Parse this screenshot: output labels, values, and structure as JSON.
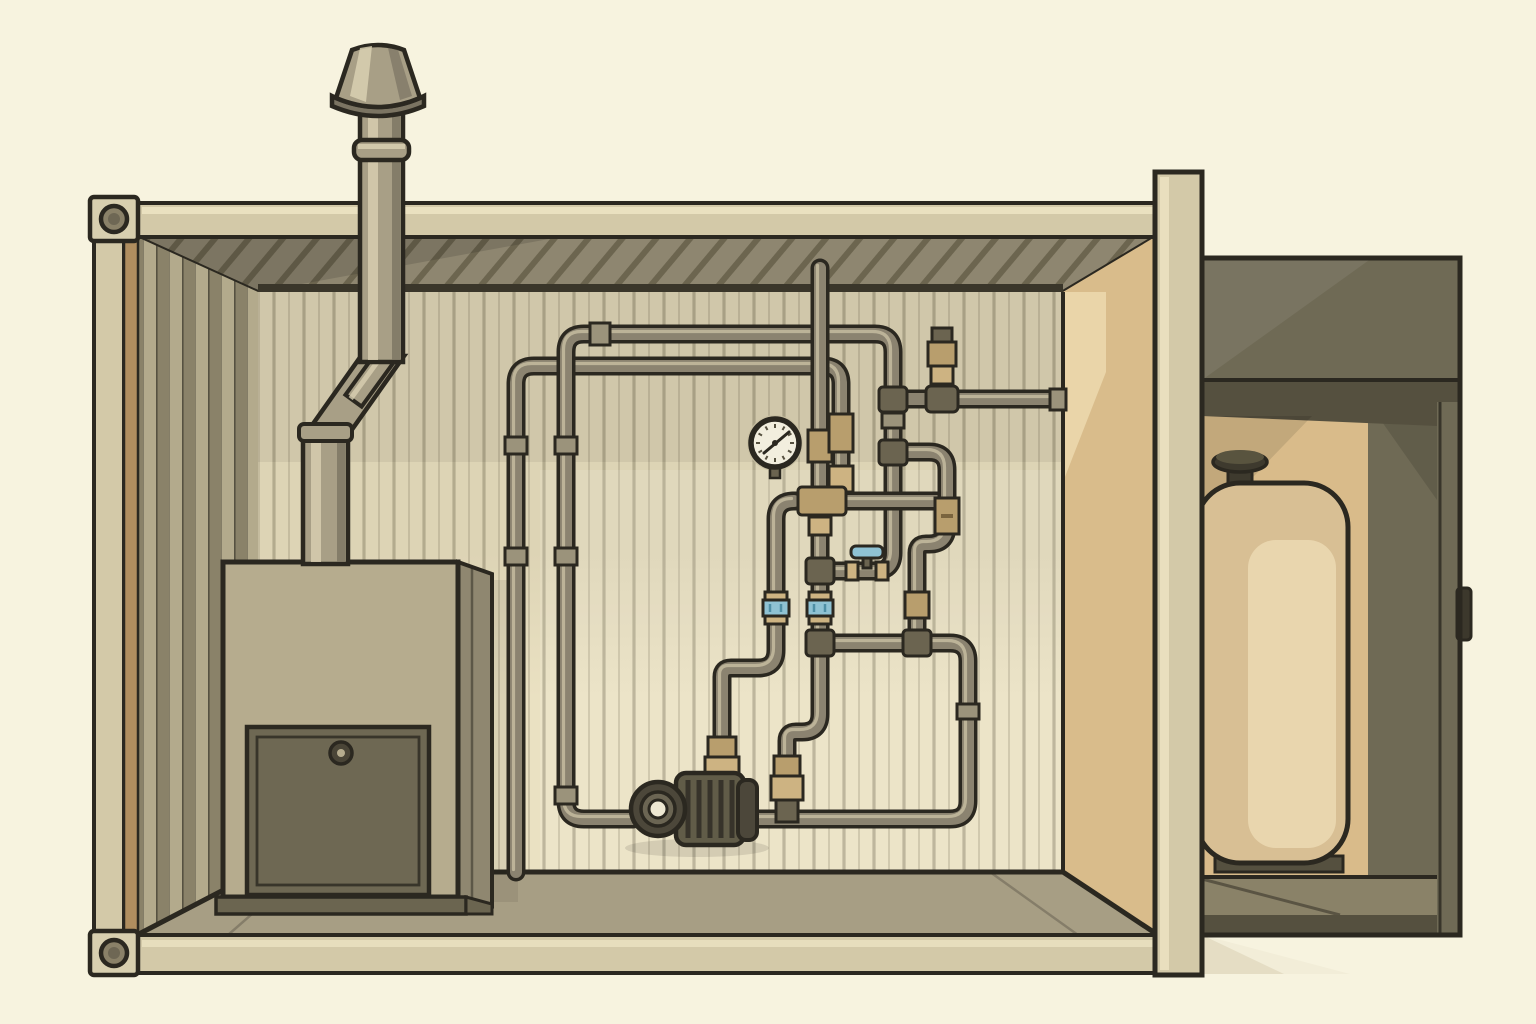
{
  "meta": {
    "title": "Cutaway illustration of a containerized boiler room with piping and side tank compartment",
    "style": "flat sepia / olive technical illustration",
    "visible_text": "none"
  },
  "colors": {
    "bg": "#f7f3df",
    "outline": "#2b2820",
    "frame": "#d3c9a8",
    "frameHi": "#ece3c2",
    "frameEdge": "#b7ad8c",
    "cornerStrip": "#b08e5f",
    "casting": "#d8cfaf",
    "castingHole": "#8a8168",
    "castingHoleIn": "#6e6754",
    "ceiling": "#8e8670",
    "ceilingHatch": "#6c654f",
    "trim": "#3a362a",
    "wall": "#ddd4b5",
    "wallLit": "#eae1c2",
    "wallGroove": "#a69d82",
    "corrugLight": "#b3aa8c",
    "corrugDark": "#8a8269",
    "rightWall": "#d9bc8b",
    "rightWallLight": "#ecd9ae",
    "floor": "#a79e84",
    "boilerFace": "#b6ac8e",
    "boilerSide": "#8f8770",
    "boilerPlinth": "#6b6550",
    "boilerDoor": "#6e6853",
    "knob": "#4a4537",
    "flue": "#a89f86",
    "flueHi": "#d9d0b2",
    "flueShade": "#7b7462",
    "pipe": "#8b8370",
    "pipeHi": "#ccc3a6",
    "sleeve": "#9b937b",
    "fitting": "#6b6450",
    "brass": "#b89e6d",
    "brassLight": "#cdb382",
    "brassDark": "#7a643e",
    "blue": "#8fc2d3",
    "blueDark": "#4f8fa5",
    "pumpBody": "#615c48",
    "pumpDark": "#4c473a",
    "pumpRib": "#37332a",
    "pumpRing": "#6b6553",
    "pumpHole": "#eee8d2",
    "gaugeFace": "#f2eede",
    "gaugeHalo": "#c9c0a2",
    "annexOlive": "#6f6a55",
    "annexDark": "#55503f",
    "annexInterior": "#d9bb8a",
    "annexFloor": "#8a8268",
    "tank": "#d8bf94",
    "tankHi": "#e9d6ae",
    "tankCap": "#3e3a2e",
    "tankCapTop": "#59543f",
    "latch": "#3c382c",
    "shadow": "rgba(150,130,80,.32)"
  },
  "components": {
    "container": {
      "kind": "shipping-container cutaway, open front",
      "corner_castings": [
        "top-left with oval hole",
        "bottom-left with oval hole"
      ],
      "walls": "corrugated left wall, paneled back wall, tan right end wall",
      "right_frame": "tall beige end pillar"
    },
    "boiler": {
      "kind": "floor-standing boiler cabinet",
      "door": "dark square access door, inset border",
      "knob": "round latch knob upper-center of door",
      "plinth": "dark base skid"
    },
    "flue": {
      "kind": "metal flue stack",
      "path": "rises from boiler top, 45-degree jog, passes roof beam",
      "collar": "storm collar ring above roof",
      "cap": "mushroom rain cap"
    },
    "pressure_gauge": {
      "kind": "round wall-mounted pressure gauge",
      "face": "white dial with tick marks",
      "needle": "pointing to upper-right"
    },
    "pump": {
      "kind": "horizontal circulator pump",
      "face": "concentric ring suction flange",
      "body": "ribbed motor housing with rear cap",
      "connections": "bottom run inline, brass riser on top"
    },
    "pipes": {
      "look": "olive steel piping, dark outlines, brass unions and tees",
      "left_loop": "two nested runs rising to ceiling-height headers",
      "right_loop": "S-bend with brass union, drop to floor run",
      "ceiling_drop": "single pipe from ceiling into manifold",
      "wall_feed": "horizontal line exiting into right end wall",
      "blue_valves": 3
    },
    "annex": {
      "kind": "attached side compartment, open front",
      "contents": "rounded storage tank with filler cap and lighter front panel",
      "latch": "small dark handle tab on right edge"
    }
  },
  "gauge": {
    "ticks": 12
  }
}
